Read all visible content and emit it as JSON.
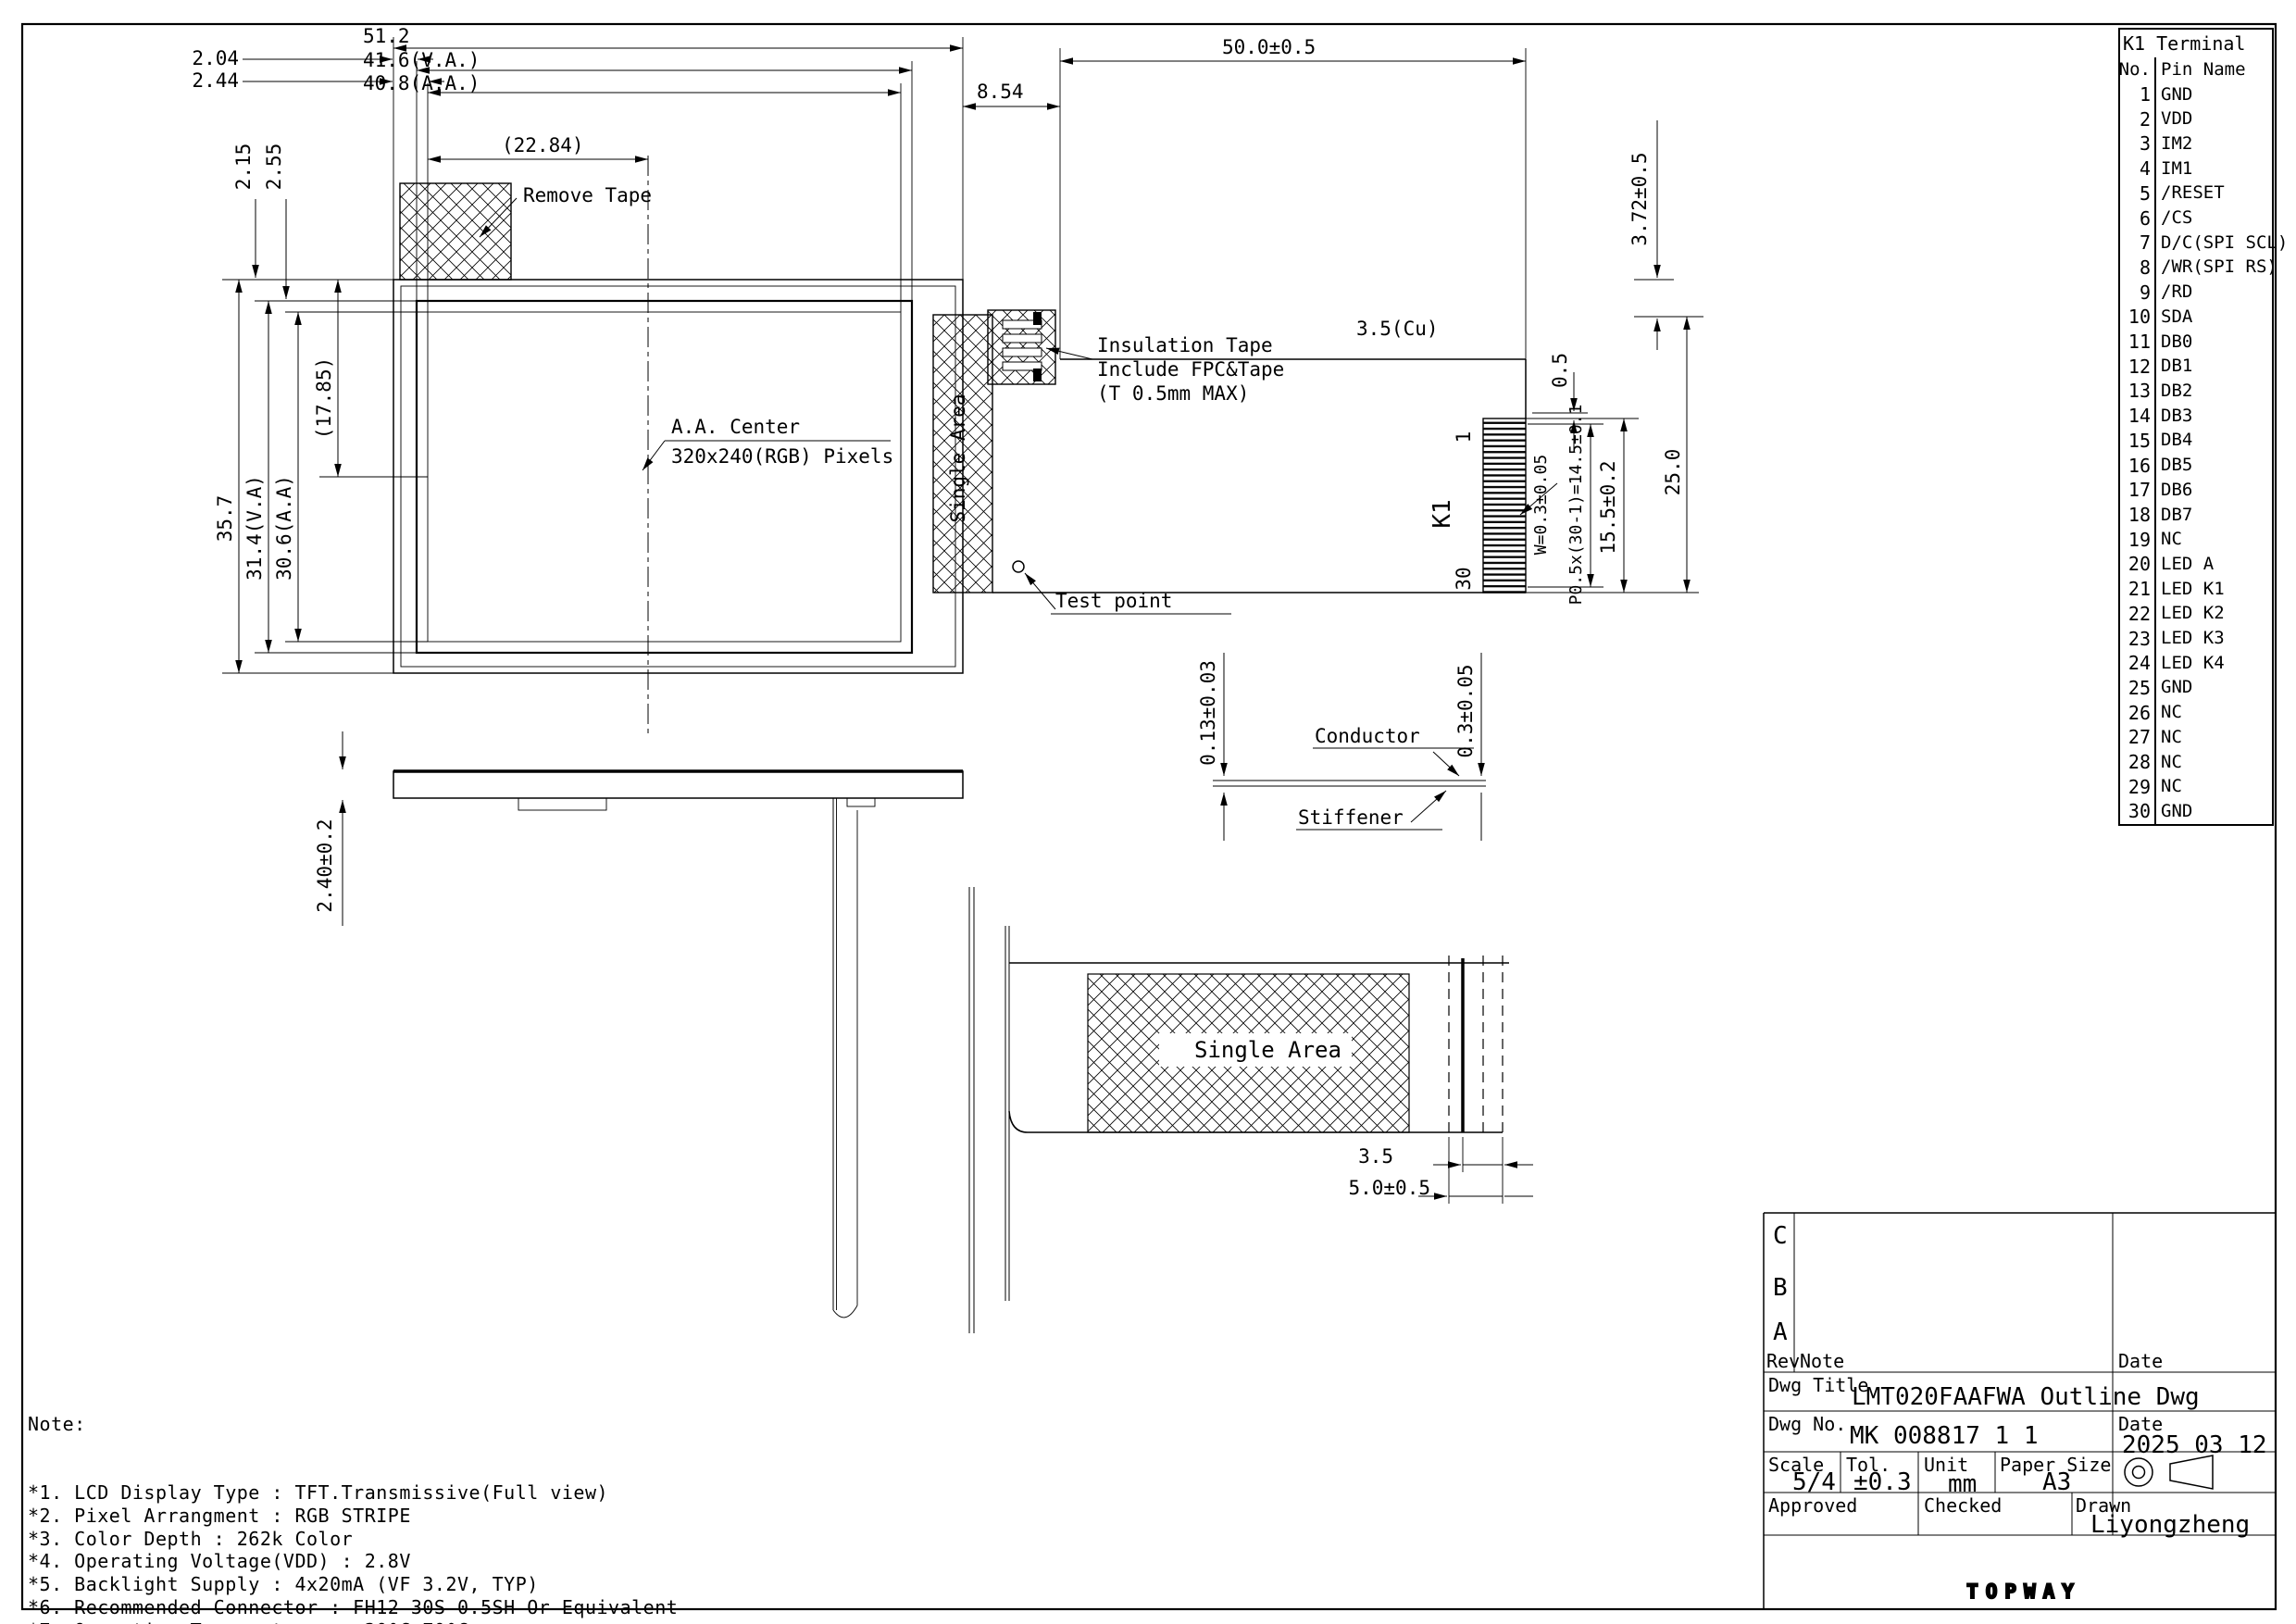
{
  "pin_table": {
    "title": "K1 Terminal",
    "col_no": "No.",
    "col_name": "Pin Name",
    "rows": [
      [
        "1",
        "GND"
      ],
      [
        "2",
        "VDD"
      ],
      [
        "3",
        "IM2"
      ],
      [
        "4",
        "IM1"
      ],
      [
        "5",
        "/RESET"
      ],
      [
        "6",
        "/CS"
      ],
      [
        "7",
        "D/C(SPI SCL)"
      ],
      [
        "8",
        "/WR(SPI RS)"
      ],
      [
        "9",
        "/RD"
      ],
      [
        "10",
        "SDA"
      ],
      [
        "11",
        "DB0"
      ],
      [
        "12",
        "DB1"
      ],
      [
        "13",
        "DB2"
      ],
      [
        "14",
        "DB3"
      ],
      [
        "15",
        "DB4"
      ],
      [
        "16",
        "DB5"
      ],
      [
        "17",
        "DB6"
      ],
      [
        "18",
        "DB7"
      ],
      [
        "19",
        "NC"
      ],
      [
        "20",
        "LED A"
      ],
      [
        "21",
        "LED K1"
      ],
      [
        "22",
        "LED K2"
      ],
      [
        "23",
        "LED K3"
      ],
      [
        "24",
        "LED K4"
      ],
      [
        "25",
        "GND"
      ],
      [
        "26",
        "NC"
      ],
      [
        "27",
        "NC"
      ],
      [
        "28",
        "NC"
      ],
      [
        "29",
        "NC"
      ],
      [
        "30",
        "GND"
      ]
    ]
  },
  "dims": {
    "width_total": "51.2",
    "width_va": "41.6(V.A.)",
    "width_aa": "40.8(A.A.)",
    "offset_204": "2.04",
    "offset_244": "2.44",
    "ref_2284": "(22.84)",
    "offset_215": "2.15",
    "offset_255": "2.55",
    "height_total": "35.7",
    "height_va": "31.4(V.A)",
    "height_aa": "30.6(A.A)",
    "ref_1785": "(17.85)",
    "d854": "8.54",
    "fpc_length": "50.0±0.5",
    "d372": "3.72±0.5",
    "d05": "0.5",
    "finger_width": "W=0.3±0.05",
    "pitch": "P0.5x(30-1)=14.5±0.1",
    "d155": "15.5±0.2",
    "d250": "25.0",
    "cu": "3.5(Cu)",
    "conductor_t": "0.13±0.03",
    "stiffener_t": "0.3±0.05",
    "thickness": "2.40±0.2",
    "d35": "3.5",
    "d50": "5.0±0.5"
  },
  "labels": {
    "remove_tape": "Remove Tape",
    "insulation_1": "Insulation Tape",
    "insulation_2": "Include FPC&Tape",
    "insulation_3": "(T 0.5mm MAX)",
    "aa_center_1": "A.A. Center",
    "aa_center_2": "320x240(RGB) Pixels",
    "single_area": "Single Area",
    "single_area_bottom": "Single Area",
    "test_point": "Test point",
    "conductor": "Conductor",
    "stiffener": "Stiffener",
    "pin_first": "1",
    "pin_last": "30",
    "connector": "K1"
  },
  "notes": {
    "heading": "Note:",
    "items": [
      "*1. LCD Display Type : TFT.Transmissive(Full view)",
      "*2. Pixel Arrangment : RGB STRIPE",
      "*3. Color Depth : 262k Color",
      "*4. Operating Voltage(VDD) : 2.8V",
      "*5. Backlight Supply : 4x20mA (VF 3.2V, TYP)",
      "*6. Recommended Connector : FH12 30S 0.5SH Or Equivalent",
      "*7. Operating Temperature :  20°C~70°C",
      "*8. Storage Temperature :  30°C~80°C"
    ]
  },
  "title_block": {
    "rev_c": "C",
    "rev_b": "B",
    "rev_a": "A",
    "rev_label": "Rev",
    "note_label": "Note",
    "date_label": "Date",
    "dwg_title_label": "Dwg Title",
    "dwg_title": "LMT020FAAFWA Outline Dwg",
    "dwg_no_label": "Dwg No.",
    "dwg_no": "MK 008817 1 1",
    "date_label2": "Date",
    "date_value": "2025 03 12",
    "scale_label": "Scale",
    "scale": "5/4",
    "tol_label": "Tol.",
    "tol": "±0.3",
    "unit_label": "Unit",
    "unit": "mm",
    "paper_label": "Paper Size",
    "paper": "A3",
    "approved_label": "Approved",
    "checked_label": "Checked",
    "drawn_label": "Drawn",
    "drawn_by": "Liyongzheng",
    "logo": "TOPWAY"
  }
}
